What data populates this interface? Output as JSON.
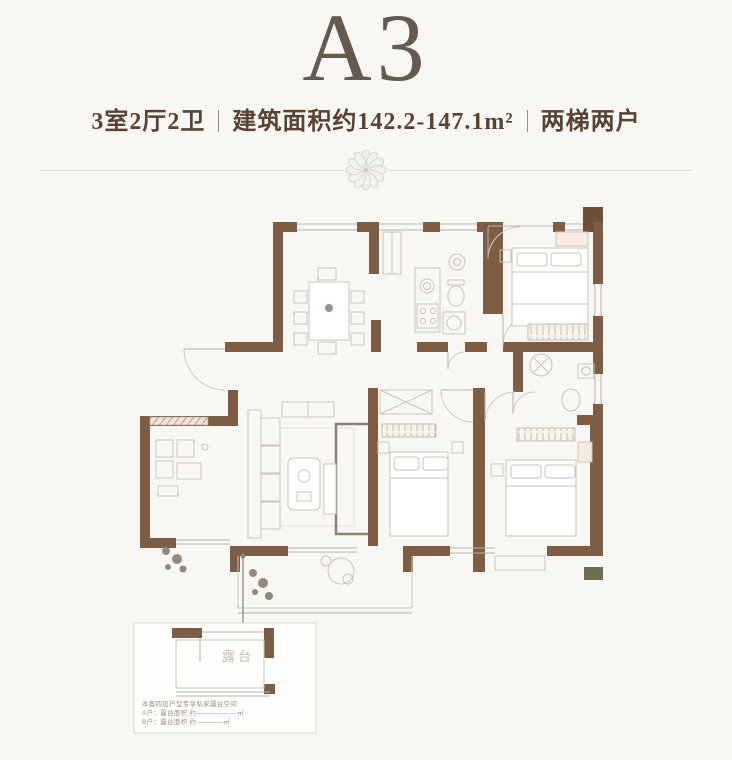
{
  "header": {
    "unit_label": "A3",
    "spec_rooms": "3室2厅2卫",
    "spec_area": "建筑面积约142.2-147.1m²",
    "spec_units": "两梯两户"
  },
  "inset": {
    "terrace_label": "露台",
    "note_lines": [
      "本案四层户型专享私家露台空间",
      "A户：露台面积 约——————㎡",
      "B户：露台面积 约————㎡"
    ]
  },
  "colors": {
    "wall": "#7d5e45",
    "wall_dark": "#6e5038",
    "title": "#645a50",
    "subtitle": "#5a4233",
    "accent_olive": "#6f6e50",
    "line_light": "#cbc4bb"
  }
}
